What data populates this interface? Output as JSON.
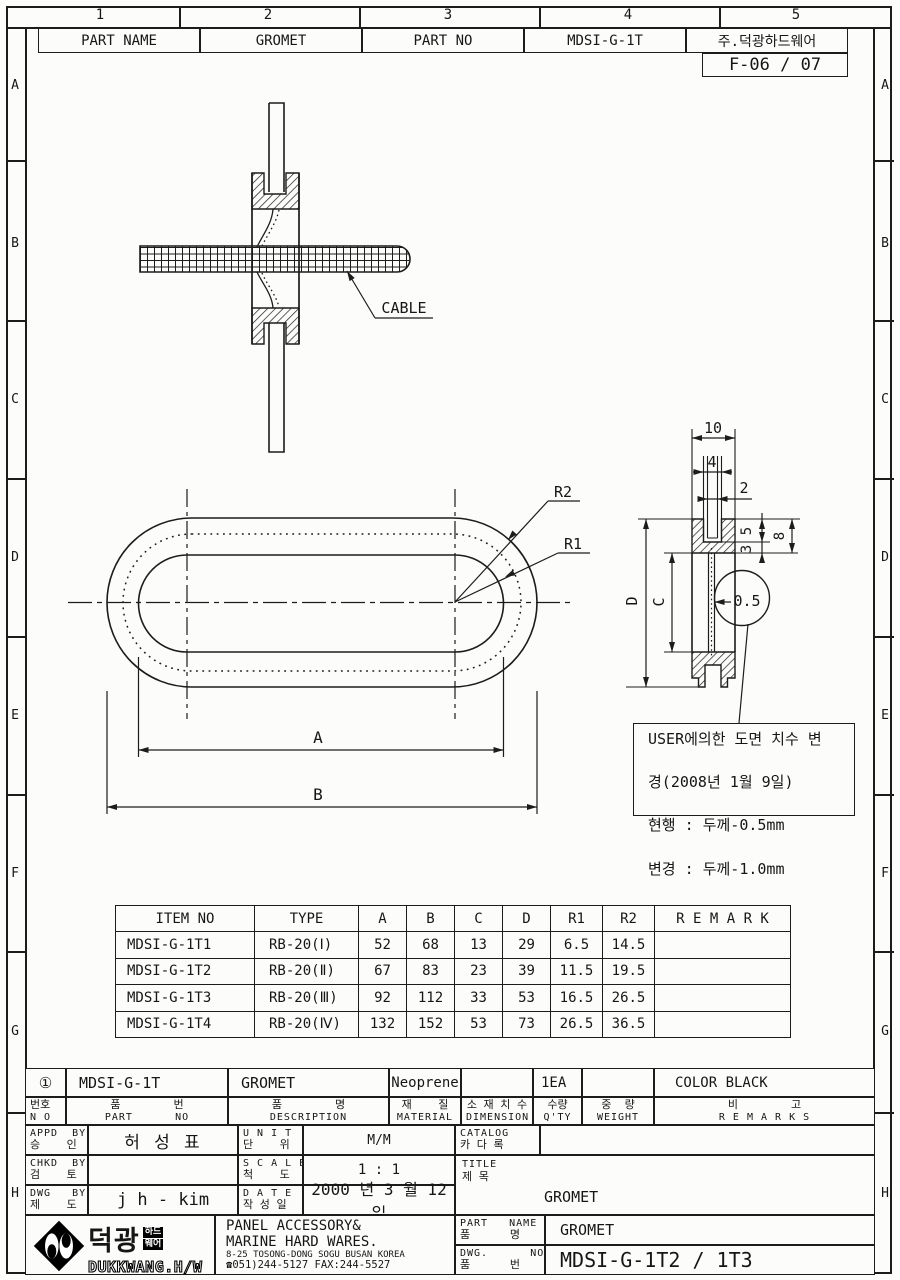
{
  "frame": {
    "columns": [
      "1",
      "2",
      "3",
      "4",
      "5"
    ],
    "rows": [
      "A",
      "B",
      "C",
      "D",
      "E",
      "F",
      "G",
      "H"
    ]
  },
  "header": {
    "cells": [
      "PART NAME",
      "GROMET",
      "PART NO",
      "MDSI-G-1T",
      "주.덕광하드웨어"
    ],
    "doc_no": "F-06 / 07"
  },
  "views": {
    "cable_label": "CABLE",
    "plan": {
      "r2": "R2",
      "r1": "R1",
      "dim_a": "A",
      "dim_b": "B"
    },
    "section": {
      "w10": "10",
      "w4": "4",
      "w2": "2",
      "h5": "5",
      "h3": "3",
      "h8": "8",
      "hD": "D",
      "hC": "C",
      "t05": "0.5"
    },
    "note": {
      "line1": "USER에의한 도면 치수 변",
      "line2": "경(2008년 1월 9일)",
      "line3": "현행 : 두께-0.5mm",
      "line4": "변경 : 두께-1.0mm"
    }
  },
  "spec_table": {
    "headers": [
      "ITEM  NO",
      "TYPE",
      "A",
      "B",
      "C",
      "D",
      "R1",
      "R2",
      "R E M A R K"
    ],
    "rows": [
      [
        "MDSI-G-1T1",
        "RB-20(Ⅰ)",
        "52",
        "68",
        "13",
        "29",
        "6.5",
        "14.5",
        ""
      ],
      [
        "MDSI-G-1T2",
        "RB-20(Ⅱ)",
        "67",
        "83",
        "23",
        "39",
        "11.5",
        "19.5",
        ""
      ],
      [
        "MDSI-G-1T3",
        "RB-20(Ⅲ)",
        "92",
        "112",
        "33",
        "53",
        "16.5",
        "26.5",
        ""
      ],
      [
        "MDSI-G-1T4",
        "RB-20(Ⅳ)",
        "132",
        "152",
        "53",
        "73",
        "26.5",
        "36.5",
        ""
      ]
    ]
  },
  "title_block": {
    "row1": {
      "no": "①",
      "part_no": "MDSI-G-1T",
      "description": "GROMET",
      "material": "Neoprene",
      "dimension": "",
      "qty": "1EA",
      "weight": "",
      "remarks": "COLOR BLACK"
    },
    "row2": {
      "no_kr": "번호",
      "no_en": "N O",
      "part_kr": "품        번",
      "part_en": "PART      NO",
      "desc_kr": "품        명",
      "desc_en": "DESCRIPTION",
      "mat_kr": "재    질",
      "mat_en": "MATERIAL",
      "dim_kr": "소 재 치 수",
      "dim_en": "DIMENSION",
      "qty_kr": "수량",
      "qty_en": "Q'TY",
      "wt_kr": "중  량",
      "wt_en": "WEIGHT",
      "rem_kr": "비        고",
      "rem_en": "R E M A R K S"
    },
    "appd": {
      "en": "APPD  BY",
      "kr": "승    인",
      "value": "허   성   표"
    },
    "chkd": {
      "en": "CHKD  BY",
      "kr": "검    토",
      "value": ""
    },
    "dwg": {
      "en": "DWG   BY",
      "kr": "제    도",
      "value": "j h - kim"
    },
    "unit": {
      "en": "U N I T",
      "kr": "단    위",
      "value": "M/M"
    },
    "scale": {
      "en": "S C A L E",
      "kr": "척    도",
      "value": "1 : 1"
    },
    "date": {
      "en": "D A T E",
      "kr": "작 성 일",
      "value": "2000 년 3 월 12 일"
    },
    "catalog": {
      "en": "CATALOG",
      "kr": "카 다 록",
      "value": ""
    },
    "title": {
      "en": "TITLE",
      "kr": "제 목",
      "value": "GROMET"
    },
    "company": {
      "line1": "PANEL ACCESSORY&",
      "line2": "MARINE HARD WARES.",
      "line3": "8-25 TOSONG-DONG SOGU BUSAN KOREA",
      "line4": "☎051)244-5127 FAX:244-5527"
    },
    "logo": {
      "kr": "덕광",
      "tag1": "하드",
      "tag2": "웨어",
      "en": "DUKKWANG.H/W"
    },
    "part_name": {
      "en": "PART   NAME",
      "kr": "품      명",
      "value": "GROMET"
    },
    "dwg_no": {
      "en": "DWG.      NO.",
      "kr": "품      번",
      "value": "MDSI-G-1T2 / 1T3"
    }
  }
}
